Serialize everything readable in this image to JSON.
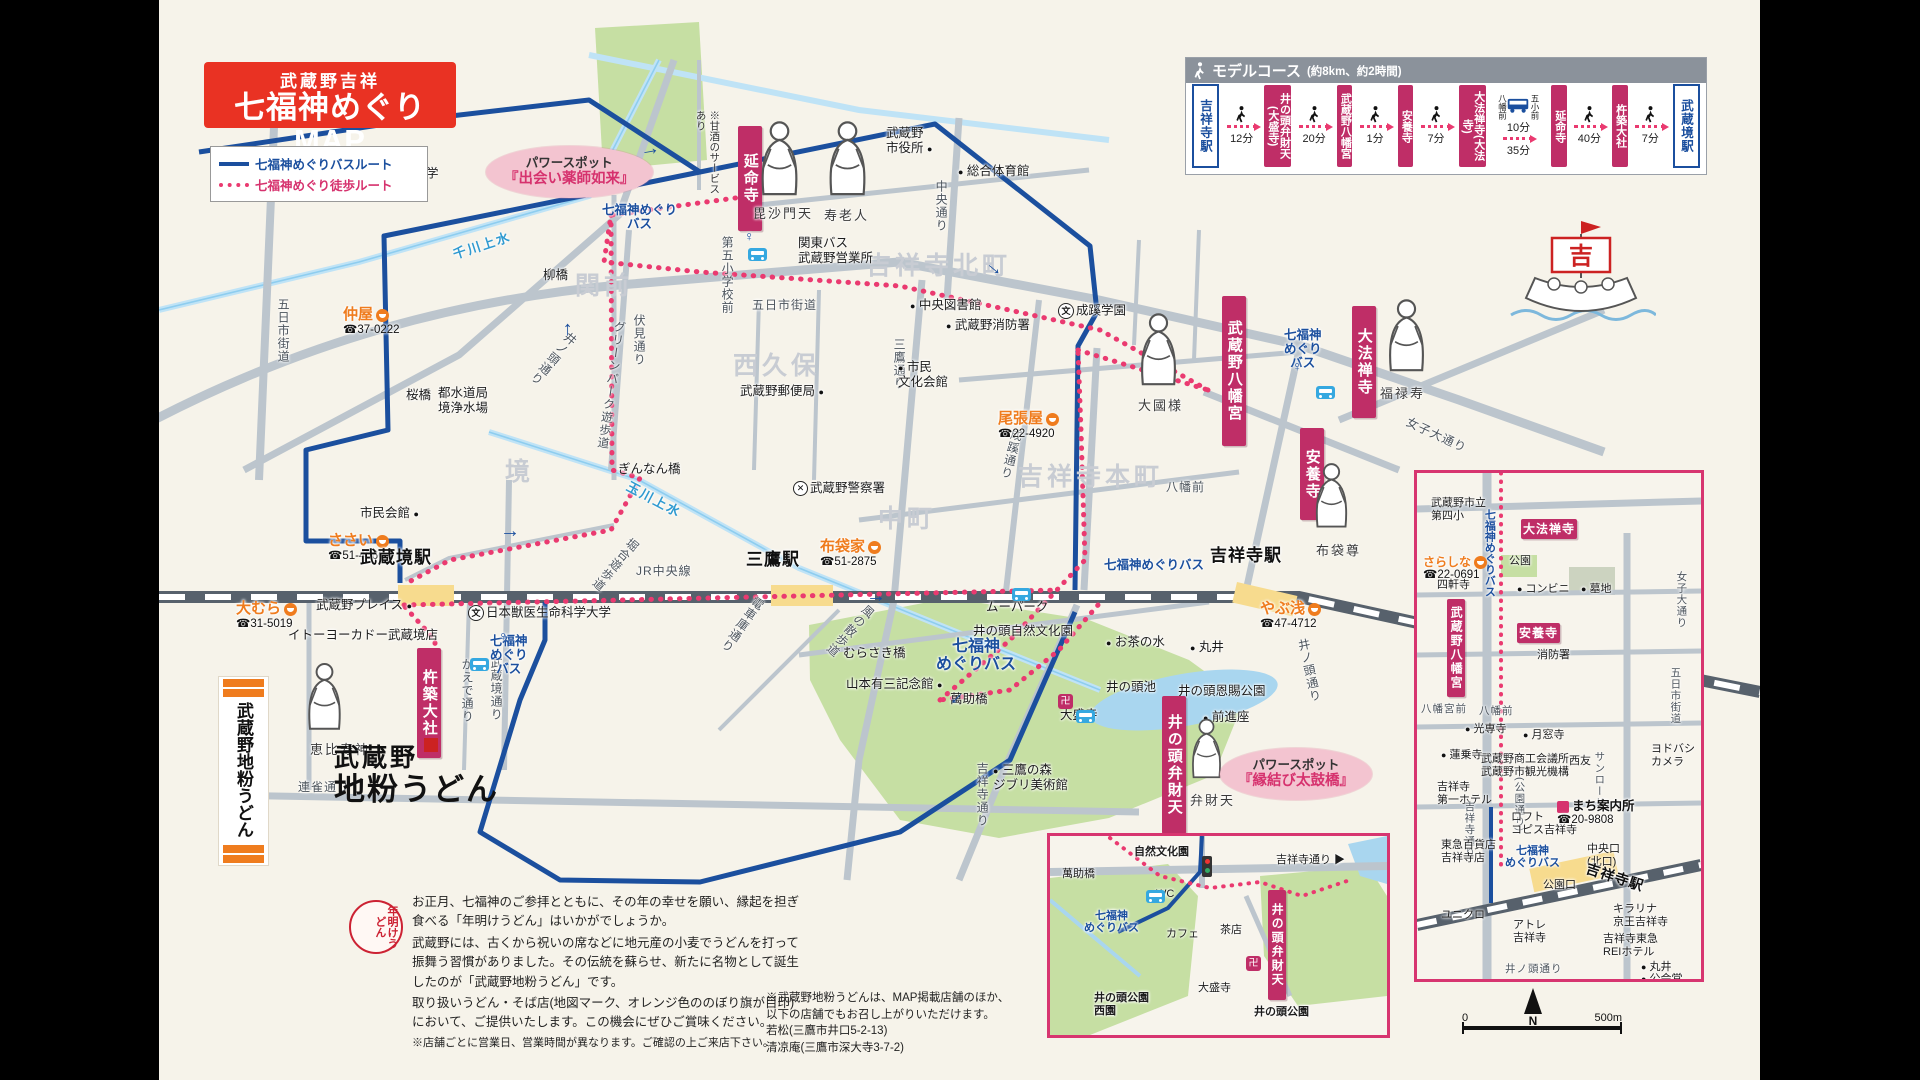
{
  "colors": {
    "accent_red": "#e93223",
    "temple_crimson": "#bf2e67",
    "bus_route_blue": "#1b4f9e",
    "walk_route_pink": "#ea3a70",
    "station_yellow": "#f7db8e",
    "shop_orange": "#ef7c1e",
    "park_green": "#c6dfa3",
    "water_blue": "#bfe3f6",
    "road_gray": "#bcc5cd",
    "area_gray": "#c8ccd3"
  },
  "title": {
    "line1": "武蔵野吉祥",
    "line2": "七福神めぐりMAP"
  },
  "legend": {
    "bus_route": "七福神めぐりバスルート",
    "walk_route": "七福神めぐり徒歩ルート"
  },
  "decor": {
    "ship_flag": "吉"
  },
  "model_course": {
    "title": "モデルコース",
    "note": "(約8km、約2時間)",
    "nodes": [
      {
        "type": "station",
        "label": "吉祥寺駅"
      },
      {
        "type": "walk",
        "time": "12分"
      },
      {
        "type": "temple",
        "label": "井の頭弁財天(大盛寺)"
      },
      {
        "type": "walk",
        "time": "20分"
      },
      {
        "type": "temple",
        "label": "武蔵野八幡宮"
      },
      {
        "type": "walk",
        "time": "1分"
      },
      {
        "type": "temple",
        "label": "安養寺"
      },
      {
        "type": "walk",
        "time": "7分"
      },
      {
        "type": "temple",
        "label": "大法禅寺(大法寺)"
      },
      {
        "type": "bus",
        "stop_from": "八幡前",
        "stop_to": "五小前",
        "time_bus": "10分",
        "time_walk": "35分"
      },
      {
        "type": "temple",
        "label": "延命寺"
      },
      {
        "type": "walk",
        "time": "40分"
      },
      {
        "type": "temple",
        "label": "杵築大社"
      },
      {
        "type": "walk",
        "time": "7分"
      },
      {
        "type": "station",
        "label": "武蔵境駅"
      }
    ]
  },
  "map": {
    "labels": [
      {
        "t": "関前",
        "type": "area",
        "x": 575,
        "y": 272
      },
      {
        "t": "西久保",
        "type": "area",
        "x": 733,
        "y": 352
      },
      {
        "t": "境",
        "type": "area",
        "x": 505,
        "y": 458
      },
      {
        "t": "中町",
        "type": "area",
        "x": 878,
        "y": 505
      },
      {
        "t": "吉祥寺北町",
        "type": "area",
        "x": 866,
        "y": 252
      },
      {
        "t": "吉祥寺本町",
        "type": "area",
        "x": 1018,
        "y": 463
      },
      {
        "t": "五日市街道",
        "type": "road",
        "v": 1,
        "x": 276,
        "y": 298
      },
      {
        "t": "五日市街道",
        "type": "road",
        "x": 752,
        "y": 298
      },
      {
        "t": "井ノ頭通り",
        "type": "road",
        "v": 1,
        "rot": 40,
        "x": 546,
        "y": 326
      },
      {
        "t": "伏見通り",
        "type": "road",
        "v": 1,
        "x": 632,
        "y": 314
      },
      {
        "t": "グリーンパーク遊歩道",
        "type": "road",
        "v": 1,
        "rot": 8,
        "x": 604,
        "y": 320
      },
      {
        "t": "三鷹通り",
        "type": "road",
        "v": 1,
        "x": 892,
        "y": 338
      },
      {
        "t": "中央通り",
        "type": "road",
        "v": 1,
        "x": 934,
        "y": 180
      },
      {
        "t": "成蹊通り",
        "type": "road",
        "v": 1,
        "rot": 14,
        "x": 1004,
        "y": 428
      },
      {
        "t": "吉祥寺通り",
        "type": "road",
        "v": 1,
        "x": 975,
        "y": 762
      },
      {
        "t": "かえで通り",
        "type": "road",
        "v": 1,
        "x": 460,
        "y": 658
      },
      {
        "t": "武蔵境通り",
        "type": "road",
        "v": 1,
        "x": 489,
        "y": 656
      },
      {
        "t": "連雀通り",
        "type": "road",
        "x": 298,
        "y": 780
      },
      {
        "t": "電車庫通り",
        "type": "road",
        "v": 1,
        "rot": 35,
        "x": 735,
        "y": 592
      },
      {
        "t": "風の散歩道",
        "type": "road",
        "v": 1,
        "rot": 42,
        "x": 843,
        "y": 598
      },
      {
        "t": "堀合遊歩道",
        "type": "road",
        "v": 1,
        "rot": 40,
        "x": 608,
        "y": 532
      },
      {
        "t": "女子大通り",
        "type": "road",
        "rot": 25,
        "x": 1404,
        "y": 428
      },
      {
        "t": "井ノ頭通り",
        "type": "road",
        "v": 1,
        "rot": -12,
        "x": 1302,
        "y": 638
      },
      {
        "t": "八幡前",
        "type": "road",
        "x": 1166,
        "y": 480
      },
      {
        "t": "第五小学校前",
        "type": "road",
        "v": 1,
        "x": 720,
        "y": 236
      },
      {
        "t": "JR中央線",
        "type": "road",
        "x": 636,
        "y": 564
      },
      {
        "t": "千川上水",
        "type": "water",
        "rot": -18,
        "x": 452,
        "y": 238
      },
      {
        "t": "玉川上水",
        "type": "water",
        "rot": 28,
        "x": 624,
        "y": 492
      },
      {
        "t": "柳橋",
        "type": "poi",
        "x": 543,
        "y": 268
      },
      {
        "t": "桜橋",
        "type": "poi",
        "x": 406,
        "y": 388
      },
      {
        "t": "都水道局\n境浄水場",
        "type": "poi",
        "x": 438,
        "y": 386
      },
      {
        "t": "武蔵野郵便局",
        "type": "poi",
        "dot": "a",
        "x": 740,
        "y": 384
      },
      {
        "t": "市民会館",
        "type": "poi",
        "dot": "a",
        "x": 360,
        "y": 506
      },
      {
        "t": "ぎんなん橋",
        "type": "poi",
        "x": 618,
        "y": 462
      },
      {
        "t": "武蔵野プレイス",
        "type": "poi",
        "dot": "a",
        "x": 316,
        "y": 598
      },
      {
        "t": "イトーヨーカドー武蔵境店",
        "type": "poi",
        "x": 288,
        "y": 628
      },
      {
        "t": "日本獣医生命科学大学",
        "type": "poi",
        "icon": "school",
        "x": 468,
        "y": 605
      },
      {
        "t": "武蔵野大学",
        "type": "poi",
        "icon": "school",
        "x": 358,
        "y": 166
      },
      {
        "t": "武蔵野\n市役所",
        "type": "poi",
        "dot": "a",
        "x": 886,
        "y": 126
      },
      {
        "t": "総合体育館",
        "type": "poi",
        "dot": "b",
        "x": 958,
        "y": 164
      },
      {
        "t": "関東バス\n武蔵野営業所",
        "type": "poi",
        "x": 798,
        "y": 236
      },
      {
        "t": "中央図書館",
        "type": "poi",
        "dot": "b",
        "x": 910,
        "y": 298
      },
      {
        "t": "武蔵野消防署",
        "type": "poi",
        "dot": "b",
        "x": 946,
        "y": 318
      },
      {
        "t": "成蹊学園",
        "type": "poi",
        "icon": "school",
        "x": 1058,
        "y": 303
      },
      {
        "t": "市民\n文化会館",
        "type": "poi",
        "dot": "b",
        "x": 898,
        "y": 360
      },
      {
        "t": "武蔵野警察署",
        "type": "poi",
        "icon": "police",
        "x": 793,
        "y": 481
      },
      {
        "t": "むらさき橋",
        "type": "poi",
        "x": 843,
        "y": 646
      },
      {
        "t": "山本有三記念館",
        "type": "poi",
        "dot": "a",
        "x": 846,
        "y": 677
      },
      {
        "t": "萬助橋",
        "type": "poi",
        "x": 950,
        "y": 692
      },
      {
        "t": "三鷹の森\nジブリ美術館",
        "type": "poi",
        "dot": "b",
        "x": 993,
        "y": 763
      },
      {
        "t": "ムーパーク",
        "type": "poi",
        "x": 986,
        "y": 600
      },
      {
        "t": "井の頭自然文化園",
        "type": "poi",
        "x": 973,
        "y": 624
      },
      {
        "t": "お茶の水",
        "type": "poi",
        "dot": "b",
        "x": 1106,
        "y": 635
      },
      {
        "t": "丸井",
        "type": "poi",
        "dot": "b",
        "x": 1190,
        "y": 640
      },
      {
        "t": "井の頭池",
        "type": "poi",
        "x": 1106,
        "y": 680
      },
      {
        "t": "井の頭恩賜公園",
        "type": "poi",
        "x": 1178,
        "y": 684
      },
      {
        "t": "前進座",
        "type": "poi",
        "dot": "b",
        "x": 1203,
        "y": 710
      },
      {
        "t": "大盛寺",
        "type": "poi",
        "x": 1060,
        "y": 708
      },
      {
        "t": "仲屋",
        "tel": "☎37-0222",
        "type": "shop",
        "x": 343,
        "y": 306
      },
      {
        "t": "ささい",
        "tel": "☎51-4366",
        "type": "shop",
        "x": 328,
        "y": 532
      },
      {
        "t": "大むら",
        "tel": "☎31-5019",
        "type": "shop",
        "x": 236,
        "y": 600
      },
      {
        "t": "尾張屋",
        "tel": "☎22-4920",
        "type": "shop",
        "x": 998,
        "y": 410
      },
      {
        "t": "布袋家",
        "tel": "☎51-2875",
        "type": "shop",
        "x": 820,
        "y": 538
      },
      {
        "t": "やぶ浅",
        "tel": "☎47-4712",
        "type": "shop",
        "x": 1260,
        "y": 600
      },
      {
        "t": "武蔵境駅",
        "type": "station",
        "x": 360,
        "y": 548
      },
      {
        "t": "三鷹駅",
        "type": "station",
        "x": 746,
        "y": 550
      },
      {
        "t": "吉祥寺駅",
        "type": "station",
        "x": 1210,
        "y": 546
      },
      {
        "t": "七福神めぐり\nバス",
        "type": "bus",
        "x": 602,
        "y": 203
      },
      {
        "t": "七福神\nめぐり\nバス",
        "type": "bus",
        "x": 1284,
        "y": 328
      },
      {
        "t": "七福神\nめぐり\nバス",
        "type": "bus",
        "x": 490,
        "y": 634
      },
      {
        "t": "七福神\nめぐりバス",
        "type": "bus",
        "big": 1,
        "x": 936,
        "y": 638
      },
      {
        "t": "七福神めぐりバス",
        "type": "bus",
        "x": 1104,
        "y": 558
      },
      {
        "t": "延命寺",
        "type": "temple",
        "x": 738,
        "y": 126,
        "h": 95
      },
      {
        "t": "武蔵野八幡宮",
        "type": "temple",
        "x": 1222,
        "y": 296,
        "h": 140
      },
      {
        "t": "大法禅寺",
        "type": "temple",
        "x": 1352,
        "y": 306,
        "h": 102
      },
      {
        "t": "安養寺",
        "type": "temple",
        "x": 1300,
        "y": 428,
        "h": 82
      },
      {
        "t": "杵築大社",
        "type": "temple",
        "x": 417,
        "y": 648,
        "h": 100
      },
      {
        "t": "井の頭弁財天",
        "type": "temple",
        "x": 1162,
        "y": 696,
        "h": 128
      },
      {
        "t": "毘沙門天",
        "type": "deity",
        "x": 753,
        "y": 206
      },
      {
        "t": "寿老人",
        "type": "deity",
        "x": 824,
        "y": 208
      },
      {
        "t": "大國様",
        "type": "deity",
        "x": 1138,
        "y": 398
      },
      {
        "t": "福禄寿",
        "type": "deity",
        "x": 1380,
        "y": 386
      },
      {
        "t": "布袋尊",
        "type": "deity",
        "x": 1316,
        "y": 543
      },
      {
        "t": "恵比寿神",
        "type": "deity",
        "x": 310,
        "y": 742
      },
      {
        "t": "弁財天",
        "type": "deity",
        "x": 1190,
        "y": 793
      },
      {
        "type": "god",
        "x": 750,
        "y": 118,
        "s": 82
      },
      {
        "type": "god",
        "x": 818,
        "y": 118,
        "s": 82
      },
      {
        "type": "god",
        "x": 1130,
        "y": 310,
        "s": 80
      },
      {
        "type": "god",
        "x": 1378,
        "y": 296,
        "s": 80
      },
      {
        "type": "god",
        "x": 1306,
        "y": 460,
        "s": 72
      },
      {
        "type": "god",
        "x": 298,
        "y": 660,
        "s": 74
      },
      {
        "type": "god",
        "x": 1183,
        "y": 716,
        "s": 66
      },
      {
        "t": "※甘酒のサービス\nあり",
        "type": "note",
        "x": 693,
        "y": 110
      },
      {
        "t": "パワースポット\n『出会い薬師如来』",
        "type": "powerspot",
        "x": 486,
        "y": 146
      },
      {
        "t": "パワースポット\n『縁結び太鼓橋』",
        "type": "powerspot",
        "x": 1220,
        "y": 748
      },
      {
        "t": "♀",
        "type": "stop",
        "x": 1292,
        "y": 358
      },
      {
        "t": "♀",
        "type": "stop",
        "x": 498,
        "y": 628
      },
      {
        "t": "♀",
        "type": "stop",
        "x": 744,
        "y": 228
      },
      {
        "type": "busicon",
        "x": 748,
        "y": 248
      },
      {
        "type": "busicon",
        "x": 1316,
        "y": 386
      },
      {
        "type": "busicon",
        "x": 470,
        "y": 658
      },
      {
        "type": "busicon",
        "x": 1012,
        "y": 588
      },
      {
        "type": "busicon",
        "x": 1076,
        "y": 710
      },
      {
        "type": "templeicon",
        "x": 1058,
        "y": 694
      },
      {
        "type": "arrow",
        "x": 640,
        "y": 138,
        "rot": -10
      },
      {
        "type": "arrow",
        "x": 985,
        "y": 256,
        "rot": 40
      },
      {
        "type": "arrow",
        "x": 500,
        "y": 520
      },
      {
        "type": "arrow",
        "x": 866,
        "y": 585
      },
      {
        "type": "arrow",
        "x": 556,
        "y": 318,
        "rot": -90
      },
      {
        "type": "arrow",
        "x": 948,
        "y": 688,
        "rot": 135
      }
    ]
  },
  "inset_right": {
    "labels": [
      {
        "t": "武蔵野市立\n第四小",
        "type": "poi",
        "x": 14,
        "y": 24
      },
      {
        "t": "七福神めぐりバス",
        "type": "bus",
        "v": 1,
        "x": 66,
        "y": 36
      },
      {
        "t": "大法禅寺",
        "type": "temple",
        "hbox": 1,
        "x": 104,
        "y": 46
      },
      {
        "t": "公園",
        "type": "poi",
        "x": 92,
        "y": 82
      },
      {
        "t": "さらしな",
        "tel": "☎22-0691",
        "type": "shop",
        "x": 6,
        "y": 82
      },
      {
        "t": "コンビニ",
        "type": "poi",
        "dot": "b",
        "x": 100,
        "y": 110
      },
      {
        "t": "墓地",
        "type": "poi",
        "dot": "b",
        "x": 164,
        "y": 110
      },
      {
        "t": "女子大通り",
        "type": "road",
        "v": 1,
        "x": 258,
        "y": 98
      },
      {
        "t": "四軒寺",
        "type": "poi",
        "x": 20,
        "y": 106
      },
      {
        "t": "武蔵野八幡宮",
        "type": "temple",
        "v": 1,
        "x": 30,
        "y": 126,
        "h": 92
      },
      {
        "t": "安養寺",
        "type": "temple",
        "hbox": 1,
        "x": 100,
        "y": 150
      },
      {
        "t": "消防署",
        "type": "poi",
        "x": 120,
        "y": 176
      },
      {
        "t": "八幡宮前",
        "type": "road",
        "x": 4,
        "y": 230
      },
      {
        "t": "八幡前",
        "type": "road",
        "x": 62,
        "y": 232
      },
      {
        "t": "五日市街道",
        "type": "road",
        "v": 1,
        "x": 252,
        "y": 194
      },
      {
        "t": "光専寺",
        "type": "poi",
        "dot": "b",
        "x": 48,
        "y": 250
      },
      {
        "t": "月窓寺",
        "type": "poi",
        "dot": "b",
        "x": 106,
        "y": 256
      },
      {
        "t": "蓮乗寺",
        "type": "poi",
        "dot": "b",
        "x": 24,
        "y": 276
      },
      {
        "t": "武蔵野商工会議所\n武蔵野市観光機構",
        "type": "poi",
        "x": 64,
        "y": 280
      },
      {
        "t": "ヨドバシ\nカメラ",
        "type": "poi",
        "x": 234,
        "y": 270
      },
      {
        "t": "吉祥寺\n第一ホテル",
        "type": "poi",
        "x": 20,
        "y": 308
      },
      {
        "t": "西友",
        "type": "poi",
        "x": 152,
        "y": 282
      },
      {
        "t": "サンロード",
        "type": "road",
        "v": 1,
        "x": 176,
        "y": 278
      },
      {
        "t": "(公園通り)",
        "type": "road",
        "v": 1,
        "x": 96,
        "y": 304
      },
      {
        "t": "吉祥寺通り",
        "type": "road",
        "v": 1,
        "x": 46,
        "y": 328
      },
      {
        "t": "ロフト\nコピス吉祥寺",
        "type": "poi",
        "x": 94,
        "y": 338
      },
      {
        "t": "まち案内所",
        "tel": "☎20-9808",
        "type": "info",
        "x": 140,
        "y": 326
      },
      {
        "t": "東急百貨店\n吉祥寺店",
        "type": "poi",
        "x": 24,
        "y": 366
      },
      {
        "t": "七福神\nめぐりバス",
        "type": "bus",
        "x": 88,
        "y": 372
      },
      {
        "t": "中央口\n(北口)",
        "type": "poi",
        "x": 170,
        "y": 370
      },
      {
        "t": "公園口",
        "type": "poi",
        "x": 126,
        "y": 406
      },
      {
        "t": "吉祥寺駅",
        "type": "station",
        "rot": 18,
        "x": 168,
        "y": 396
      },
      {
        "t": "キラリナ\n京王吉祥寺",
        "type": "poi",
        "x": 196,
        "y": 430
      },
      {
        "t": "ユニクロ",
        "type": "poi",
        "x": 24,
        "y": 436
      },
      {
        "t": "アトレ\n吉祥寺",
        "type": "poi",
        "x": 96,
        "y": 446
      },
      {
        "t": "吉祥寺東急\nREIホテル",
        "type": "poi",
        "x": 186,
        "y": 460
      },
      {
        "t": "井ノ頭通り",
        "type": "road",
        "x": 88,
        "y": 490
      },
      {
        "t": "丸井",
        "type": "poi",
        "dot": "b",
        "x": 224,
        "y": 488
      },
      {
        "t": "公会堂",
        "type": "poi",
        "dot": "b",
        "x": 224,
        "y": 500
      }
    ]
  },
  "inset_bottom": {
    "labels": [
      {
        "t": "自然文化園",
        "type": "poi",
        "big": 1,
        "x": 84,
        "y": 10
      },
      {
        "t": "吉祥寺通り ▶",
        "type": "poi",
        "x": 226,
        "y": 18
      },
      {
        "t": "萬助橋",
        "type": "poi",
        "x": 12,
        "y": 32
      },
      {
        "t": "WC",
        "type": "poi",
        "x": 106,
        "y": 52
      },
      {
        "t": "七福神\nめぐりバス",
        "type": "bus",
        "x": 34,
        "y": 74
      },
      {
        "t": "カフェ",
        "type": "poi",
        "x": 116,
        "y": 92
      },
      {
        "t": "茶店",
        "type": "poi",
        "x": 170,
        "y": 88
      },
      {
        "t": "井の頭弁財天",
        "type": "temple",
        "v": 1,
        "x": 218,
        "y": 54,
        "h": 104
      },
      {
        "t": "大盛寺",
        "type": "poi",
        "x": 148,
        "y": 146
      },
      {
        "t": "井の頭公園\n西園",
        "type": "poi",
        "big": 1,
        "x": 44,
        "y": 156
      },
      {
        "t": "井の頭公園",
        "type": "poi",
        "big": 1,
        "x": 204,
        "y": 170
      },
      {
        "type": "busicon",
        "x": 96,
        "y": 54
      },
      {
        "type": "templeicon",
        "x": 196,
        "y": 120
      },
      {
        "type": "signal",
        "x": 152,
        "y": 20
      }
    ]
  },
  "udon": {
    "banner_text": "武蔵野地粉うどん",
    "logo_line1": "武蔵野",
    "logo_line2": "地粉うどん",
    "seal_text": "年明けうどん",
    "para1": "お正月、七福神のご参拝とともに、その年の幸せを願い、縁起を担ぎ食べる「年明けうどん」はいかがでしょうか。",
    "para2": "武蔵野には、古くから祝いの席などに地元産の小麦でうどんを打って振舞う習慣がありました。その伝統を蘇らせ、新たに名物として誕生したのが「武蔵野地粉うどん」です。",
    "para3": "取り扱いうどん・そば店(地図マーク、オレンジ色ののぼり旗が目印)において、ご提供いたします。この機会にぜひご賞味ください。",
    "para4": "※店舗ごとに営業日、営業時間が異なります。ご確認の上ご来店下さい。"
  },
  "footnote": {
    "line1": "※武蔵野地粉うどんは、MAP掲載店舗のほか、",
    "line2": "以下の店舗でもお召し上がりいただけます。",
    "shop1": "若松(三鷹市井口5-2-13)",
    "shop2": "清凉庵(三鷹市深大寺3-7-2)"
  },
  "scalebar": {
    "start": "0",
    "end": "500m",
    "compass": "N"
  }
}
